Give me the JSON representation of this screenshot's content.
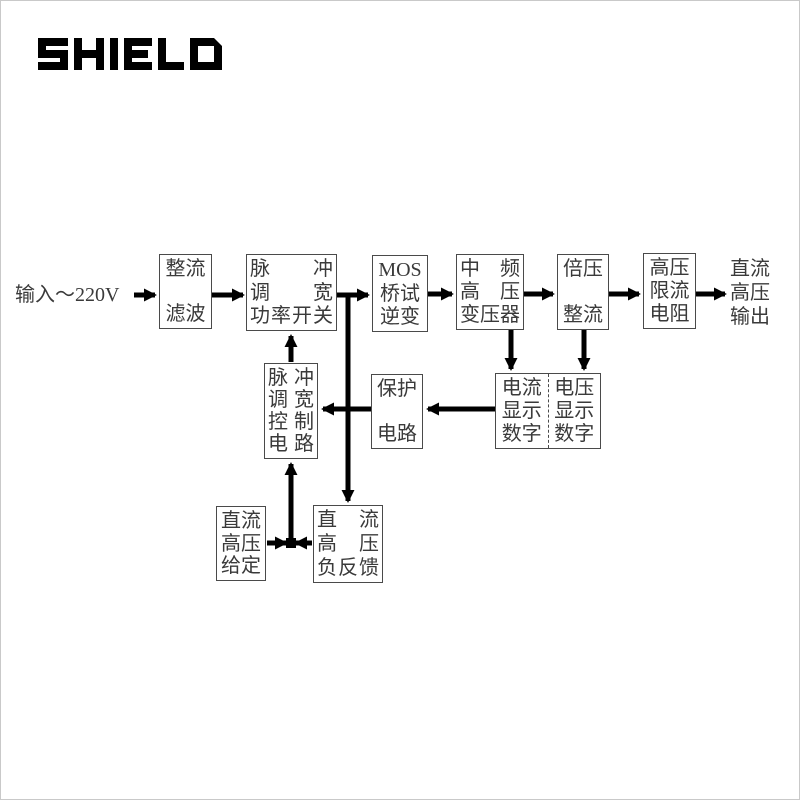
{
  "logo": {
    "text": "SHIELD"
  },
  "diagram": {
    "input_label": "输入～220V",
    "output_label": {
      "lines": [
        "直流",
        "高压",
        "输出"
      ]
    },
    "boxes": {
      "rectifier_filter": {
        "lines": [
          "整流",
          "滤波"
        ]
      },
      "pwm_power_switch": {
        "lines": [
          "脉冲",
          "调宽",
          "功率开关"
        ]
      },
      "mos_bridge_inverter": {
        "lines": [
          "MOS",
          "桥试",
          "逆变"
        ]
      },
      "mf_hv_transformer": {
        "lines": [
          "中频",
          "高压",
          "变压器"
        ]
      },
      "voltage_doubler_rectifier": {
        "lines": [
          "倍压",
          "整流"
        ]
      },
      "hv_current_limit_resistor": {
        "lines": [
          "高压",
          "限流",
          "电阻"
        ]
      },
      "pwm_control_circuit": {
        "lines": [
          "脉冲",
          "调宽",
          "控制",
          "电路"
        ]
      },
      "protection_circuit": {
        "lines": [
          "保护",
          "电路"
        ]
      },
      "current_display_digits": {
        "lines": [
          "电流",
          "显示",
          "数字"
        ]
      },
      "voltage_display_digits": {
        "lines": [
          "电压",
          "显示",
          "数字"
        ]
      },
      "dc_hv_setting": {
        "lines": [
          "直流",
          "高压",
          "给定"
        ]
      },
      "dc_hv_negative_feedback": {
        "lines": [
          "直流",
          "高压",
          "负反馈"
        ]
      }
    },
    "colors": {
      "wire": "#000000",
      "box_border": "#4a4a4a",
      "text": "#3a3a3a",
      "background": "#ffffff",
      "logo": "#000000"
    }
  }
}
